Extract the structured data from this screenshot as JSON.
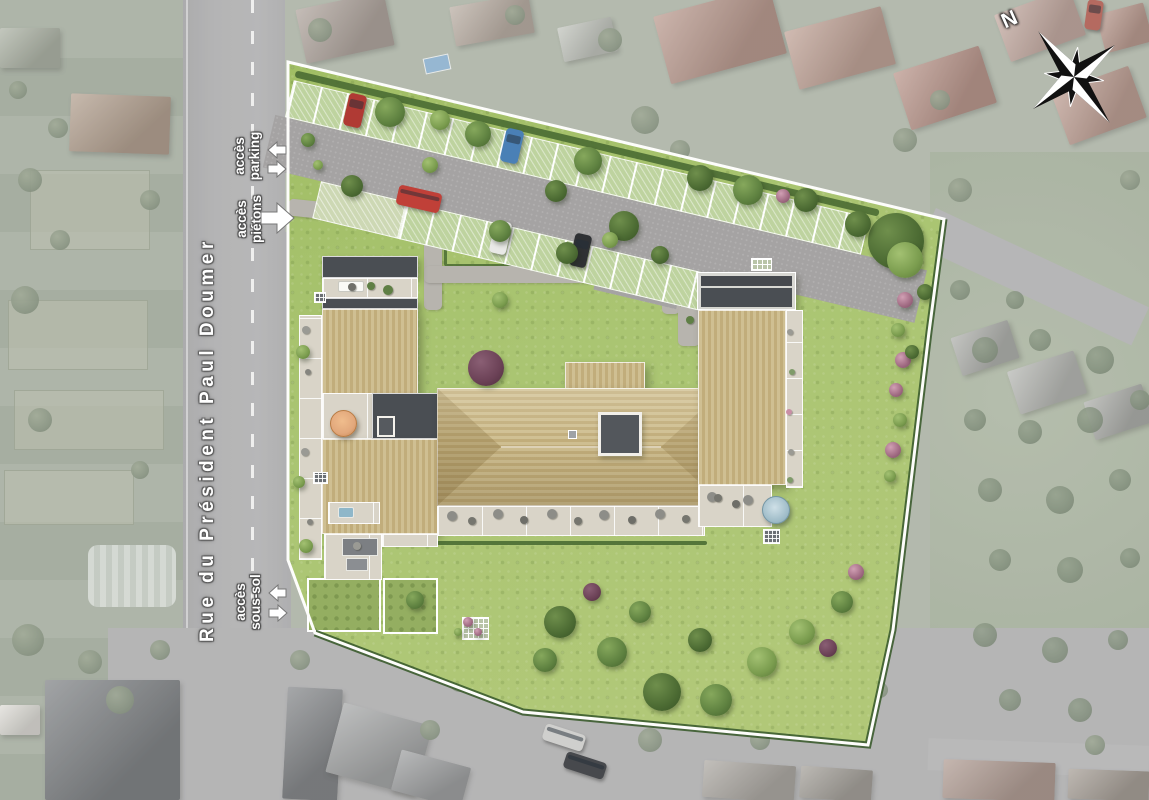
{
  "street": {
    "name": "Rue du Président Paul Doumer"
  },
  "labels": {
    "parking": {
      "line1": "accès",
      "line2": "parking"
    },
    "pietons": {
      "line1": "accès",
      "line2": "piétons"
    },
    "soussol": {
      "line1": "accès",
      "line2": "sous-sol"
    }
  },
  "compass": {
    "north_label": "N"
  },
  "colors": {
    "lawn": "#a6c169",
    "road": "#9e9ea0",
    "driveway": "#a5a3a3",
    "parking_stall": "#bed39f",
    "roof_tan_light": "#cfbf92",
    "roof_tan_dark": "#c1ad7b",
    "roof_flat_dark": "#4a4e53",
    "paver": "#d9d4c8",
    "site_border": "#ffffff",
    "hedge": "#4a6c33",
    "label_text": "#ffffff",
    "tree_palettes": {
      "1": [
        "#6f8f4c",
        "#4c6b33",
        "#3a5527"
      ],
      "2": [
        "#86a85c",
        "#5e8140",
        "#48652f"
      ],
      "3": [
        "#a3c172",
        "#7a9c4e",
        "#5d7b3a"
      ],
      "4": [
        "#d1a0b4",
        "#a06a82",
        "#7e4f66"
      ],
      "5": [
        "#8a5f74",
        "#6b4156",
        "#50303f"
      ],
      "m": [
        "#8a967f",
        "#6f7d68",
        "#5c6a56"
      ],
      "f": [
        "#76866e",
        "#5f7059",
        "#4e5e49"
      ]
    }
  },
  "scene": {
    "trees": [
      [
        390,
        112,
        15,
        "2"
      ],
      [
        478,
        134,
        13,
        "2"
      ],
      [
        352,
        186,
        11,
        "1"
      ],
      [
        588,
        161,
        14,
        "2"
      ],
      [
        556,
        191,
        11,
        "1"
      ],
      [
        624,
        226,
        15,
        "1"
      ],
      [
        500,
        231,
        11,
        "2"
      ],
      [
        567,
        253,
        11,
        "1"
      ],
      [
        610,
        240,
        8,
        "3"
      ],
      [
        660,
        255,
        9,
        "1"
      ],
      [
        700,
        178,
        13,
        "1"
      ],
      [
        748,
        190,
        15,
        "2"
      ],
      [
        806,
        200,
        12,
        "1"
      ],
      [
        783,
        196,
        7,
        "4"
      ],
      [
        896,
        241,
        28,
        "1"
      ],
      [
        858,
        224,
        13,
        "1"
      ],
      [
        905,
        260,
        18,
        "3"
      ],
      [
        500,
        300,
        8,
        "3"
      ],
      [
        486,
        368,
        18,
        "5"
      ],
      [
        905,
        300,
        8,
        "4"
      ],
      [
        898,
        330,
        7,
        "3"
      ],
      [
        903,
        360,
        8,
        "4"
      ],
      [
        896,
        390,
        7,
        "4"
      ],
      [
        900,
        420,
        7,
        "3"
      ],
      [
        893,
        450,
        8,
        "4"
      ],
      [
        890,
        476,
        6,
        "3"
      ],
      [
        303,
        352,
        7,
        "3"
      ],
      [
        299,
        482,
        6,
        "3"
      ],
      [
        306,
        546,
        7,
        "3"
      ],
      [
        308,
        140,
        7,
        "2"
      ],
      [
        318,
        165,
        5,
        "3"
      ],
      [
        440,
        120,
        10,
        "3"
      ],
      [
        430,
        165,
        8,
        "3"
      ],
      [
        560,
        622,
        16,
        "1"
      ],
      [
        612,
        652,
        15,
        "2"
      ],
      [
        662,
        692,
        19,
        "1"
      ],
      [
        716,
        700,
        16,
        "2"
      ],
      [
        762,
        662,
        15,
        "3"
      ],
      [
        802,
        632,
        13,
        "3"
      ],
      [
        842,
        602,
        11,
        "2"
      ],
      [
        592,
        592,
        9,
        "5"
      ],
      [
        640,
        612,
        11,
        "2"
      ],
      [
        828,
        648,
        9,
        "5"
      ],
      [
        856,
        572,
        8,
        "4"
      ],
      [
        545,
        660,
        12,
        "2"
      ],
      [
        700,
        640,
        12,
        "1"
      ],
      [
        415,
        600,
        9,
        "2"
      ],
      [
        468,
        622,
        5,
        "4"
      ],
      [
        478,
        632,
        4,
        "4"
      ],
      [
        458,
        632,
        4,
        "3"
      ],
      [
        925,
        292,
        8,
        "1"
      ],
      [
        912,
        352,
        7,
        "1"
      ]
    ],
    "muted_trees": [
      [
        30,
        180,
        12
      ],
      [
        60,
        240,
        10
      ],
      [
        25,
        300,
        14
      ],
      [
        150,
        200,
        10
      ],
      [
        40,
        420,
        12
      ],
      [
        140,
        470,
        9
      ],
      [
        28,
        640,
        16
      ],
      [
        90,
        662,
        12
      ],
      [
        160,
        650,
        10
      ],
      [
        120,
        700,
        14
      ],
      [
        58,
        128,
        10
      ],
      [
        18,
        90,
        9
      ],
      [
        320,
        30,
        12
      ],
      [
        515,
        15,
        10
      ],
      [
        610,
        40,
        12
      ],
      [
        645,
        120,
        14
      ],
      [
        680,
        150,
        10
      ],
      [
        905,
        140,
        12
      ],
      [
        940,
        100,
        10
      ],
      [
        1130,
        180,
        10
      ],
      [
        960,
        190,
        12
      ],
      [
        300,
        660,
        10
      ],
      [
        460,
        680,
        12
      ],
      [
        500,
        660,
        9
      ],
      [
        430,
        730,
        10
      ],
      [
        650,
        740,
        12
      ],
      [
        760,
        740,
        10
      ],
      [
        880,
        690,
        8
      ],
      [
        1095,
        745,
        10
      ]
    ],
    "field_bushes": [
      [
        985,
        350,
        13
      ],
      [
        1040,
        340,
        11
      ],
      [
        1100,
        360,
        14
      ],
      [
        975,
        420,
        11
      ],
      [
        1030,
        432,
        12
      ],
      [
        1090,
        420,
        13
      ],
      [
        1140,
        400,
        10
      ],
      [
        990,
        490,
        12
      ],
      [
        1060,
        500,
        14
      ],
      [
        1120,
        480,
        11
      ],
      [
        1000,
        560,
        11
      ],
      [
        1070,
        570,
        13
      ],
      [
        1130,
        558,
        10
      ],
      [
        985,
        635,
        12
      ],
      [
        1055,
        650,
        13
      ],
      [
        1118,
        640,
        10
      ],
      [
        1010,
        700,
        11
      ],
      [
        1080,
        710,
        12
      ],
      [
        960,
        290,
        10
      ],
      [
        1015,
        300,
        9
      ]
    ],
    "houses": [
      [
        300,
        0,
        90,
        55,
        -12,
        "#9b8d85"
      ],
      [
        452,
        0,
        80,
        40,
        -10,
        "#a8998d"
      ],
      [
        560,
        22,
        55,
        35,
        -12,
        "#b2b6ae"
      ],
      [
        660,
        0,
        120,
        70,
        -15,
        "#a87f72"
      ],
      [
        790,
        18,
        100,
        60,
        -15,
        "#b08a7c"
      ],
      [
        900,
        58,
        90,
        60,
        -18,
        "#a87a6e"
      ],
      [
        1000,
        0,
        80,
        50,
        -20,
        "#b5948a"
      ],
      [
        1058,
        78,
        82,
        55,
        -20,
        "#ad8578"
      ],
      [
        1100,
        8,
        49,
        40,
        -15,
        "#a87f72"
      ],
      [
        70,
        95,
        100,
        58,
        2,
        "#a08874"
      ],
      [
        0,
        28,
        60,
        40,
        0,
        "#98a090"
      ],
      [
        955,
        328,
        60,
        40,
        -18,
        "#9a9c98"
      ],
      [
        1012,
        360,
        70,
        45,
        -18,
        "#a3a5a1"
      ],
      [
        1088,
        392,
        61,
        40,
        -18,
        "#979995"
      ],
      [
        45,
        680,
        135,
        120,
        0,
        "#5d6166"
      ],
      [
        0,
        705,
        40,
        30,
        0,
        "#d8d6d0"
      ],
      [
        285,
        688,
        55,
        112,
        3,
        "#64676c"
      ],
      [
        333,
        713,
        92,
        72,
        15,
        "#8e9092"
      ],
      [
        395,
        758,
        72,
        42,
        15,
        "#85878a"
      ],
      [
        703,
        763,
        92,
        37,
        4,
        "#97928c"
      ],
      [
        800,
        768,
        72,
        32,
        4,
        "#8d8881"
      ],
      [
        943,
        761,
        112,
        39,
        2,
        "#9c8278"
      ],
      [
        1068,
        770,
        81,
        30,
        2,
        "#8f857c"
      ]
    ],
    "cars": [
      [
        346,
        94,
        18,
        33,
        13,
        "#b03a34"
      ],
      [
        503,
        129,
        18,
        34,
        13,
        "#4a80b6"
      ],
      [
        397,
        189,
        44,
        20,
        13,
        "#c04038"
      ],
      [
        492,
        221,
        17,
        33,
        13,
        "#e9e9e7"
      ],
      [
        572,
        234,
        17,
        33,
        13,
        "#2f3134"
      ],
      [
        543,
        729,
        42,
        17,
        18,
        "#cfcfcd"
      ],
      [
        564,
        757,
        42,
        17,
        18,
        "#47494d"
      ],
      [
        1086,
        0,
        16,
        30,
        8,
        "#b56a60"
      ]
    ],
    "furniture": [
      [
        452,
        516,
        5,
        "#8d8d88"
      ],
      [
        472,
        521,
        4,
        "#76766f"
      ],
      [
        498,
        514,
        5,
        "#8d8d88"
      ],
      [
        524,
        520,
        4,
        "#6e6e68"
      ],
      [
        552,
        514,
        5,
        "#8d8d88"
      ],
      [
        578,
        521,
        4,
        "#76766f"
      ],
      [
        604,
        515,
        5,
        "#8d8d88"
      ],
      [
        632,
        520,
        4,
        "#6e6e68"
      ],
      [
        660,
        514,
        5,
        "#8d8d88"
      ],
      [
        686,
        519,
        4,
        "#76766f"
      ],
      [
        712,
        497,
        5,
        "#8d8d88"
      ],
      [
        736,
        504,
        4,
        "#6e6e68"
      ],
      [
        718,
        498,
        4,
        "#76766f"
      ],
      [
        306,
        330,
        4,
        "#9a9a94"
      ],
      [
        308,
        372,
        3,
        "#85857f"
      ],
      [
        305,
        452,
        4,
        "#9a9a94"
      ],
      [
        310,
        522,
        3,
        "#85857f"
      ],
      [
        790,
        332,
        3,
        "#9a9a94"
      ],
      [
        792,
        372,
        3,
        "#7f9b6a"
      ],
      [
        789,
        412,
        3,
        "#c98fa6"
      ],
      [
        791,
        452,
        3,
        "#9a9a94"
      ],
      [
        790,
        480,
        3,
        "#7f9b6a"
      ],
      [
        352,
        287,
        4,
        "#6f6f69"
      ],
      [
        371,
        286,
        4,
        "#5f7f45"
      ],
      [
        388,
        290,
        5,
        "#5f7f45"
      ],
      [
        748,
        500,
        5,
        "#8d8d88"
      ],
      [
        357,
        546,
        4,
        "#9a9a94"
      ],
      [
        690,
        320,
        4,
        "#5f7f45"
      ]
    ]
  }
}
